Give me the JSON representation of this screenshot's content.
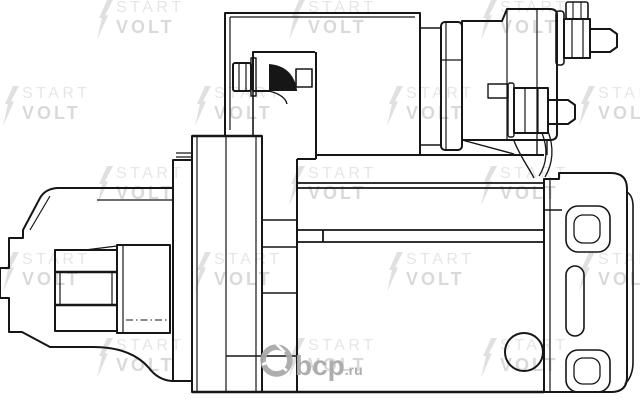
{
  "canvas": {
    "width": 640,
    "height": 402,
    "background_color": "#ffffff"
  },
  "drawing": {
    "subject": "Starter motor technical line drawing, side view",
    "line_color": "#161616",
    "parts": [
      "drive-end-housing",
      "pinion-gear",
      "mounting-flange",
      "motor-yoke",
      "solenoid",
      "b-plus-terminal",
      "switch-terminal",
      "rear-end-cap"
    ]
  },
  "watermark": {
    "icon": "lightning-bolt",
    "line1": "START",
    "line2": "VOLT",
    "line1_color": "rgba(0,0,0,0.10)",
    "line2_color": "rgba(0,0,0,0.15)",
    "bolt_color": "rgba(0,0,0,0.12)",
    "tiles": [
      {
        "x": 96,
        "y": 0
      },
      {
        "x": 288,
        "y": 0
      },
      {
        "x": 480,
        "y": 0
      },
      {
        "x": 2,
        "y": 86
      },
      {
        "x": 194,
        "y": 86
      },
      {
        "x": 386,
        "y": 86
      },
      {
        "x": 578,
        "y": 86
      },
      {
        "x": 96,
        "y": 166
      },
      {
        "x": 288,
        "y": 166
      },
      {
        "x": 480,
        "y": 166
      },
      {
        "x": 2,
        "y": 252
      },
      {
        "x": 194,
        "y": 252
      },
      {
        "x": 386,
        "y": 252
      },
      {
        "x": 578,
        "y": 252
      },
      {
        "x": 96,
        "y": 338
      },
      {
        "x": 288,
        "y": 338
      },
      {
        "x": 480,
        "y": 338
      }
    ]
  },
  "stamp": {
    "icon": "abcp-circle-logo",
    "text": "bcp",
    "suffix": ".ru",
    "color": "#a8a8a8"
  }
}
